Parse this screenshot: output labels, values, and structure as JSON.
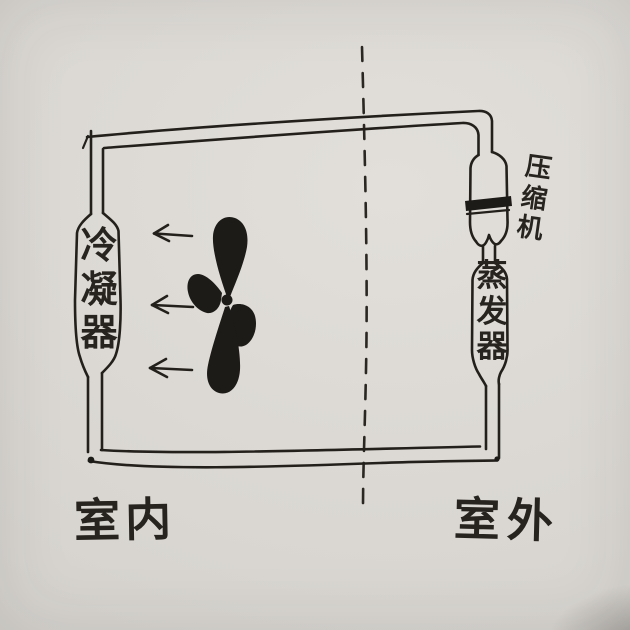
{
  "diagram": {
    "colors": {
      "ink": "#23201c",
      "paper": "#d9d6d1"
    },
    "components": {
      "condenser": {
        "label": "冷凝器"
      },
      "compressor": {
        "label": "压缩机"
      },
      "evaporator": {
        "label": "蒸发器"
      }
    },
    "zones": {
      "indoor": {
        "label": "室内"
      },
      "outdoor": {
        "label": "室外"
      }
    },
    "fan": {
      "blades": 4
    },
    "airflow_arrows": {
      "count": 3,
      "direction": "left"
    },
    "boundary_line": {
      "style": "dashed",
      "orientation": "vertical"
    }
  }
}
